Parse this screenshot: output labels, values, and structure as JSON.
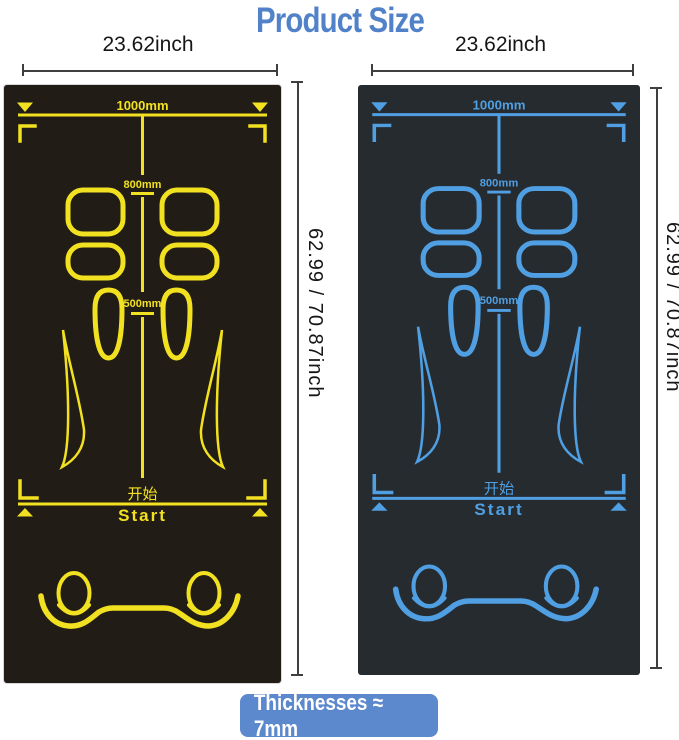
{
  "title": {
    "text": "Product Size",
    "color": "#5181c8"
  },
  "left_panel": {
    "width_label": "23.62inch",
    "height_label": "62.99 / 70.87inch",
    "mat": {
      "background_color": "#211c15",
      "line_color": "#f2e120",
      "top_marking": "1000mm",
      "middle_marking": "800mm",
      "lower_marking": "500mm",
      "start_label_cn": "开始",
      "start_label_en": "Start"
    }
  },
  "right_panel": {
    "width_label": "23.62inch",
    "height_label": "62.99 / 70.87inch",
    "mat": {
      "background_color": "#262b30",
      "line_color": "#4f9fe2",
      "top_marking": "1000mm",
      "middle_marking": "800mm",
      "lower_marking": "500mm",
      "start_label_cn": "开始",
      "start_label_en": "Start"
    }
  },
  "footer_badge": {
    "text": "Thicknesses ≈ 7mm",
    "background_color": "#5c88cd",
    "text_color": "#ffffff"
  }
}
